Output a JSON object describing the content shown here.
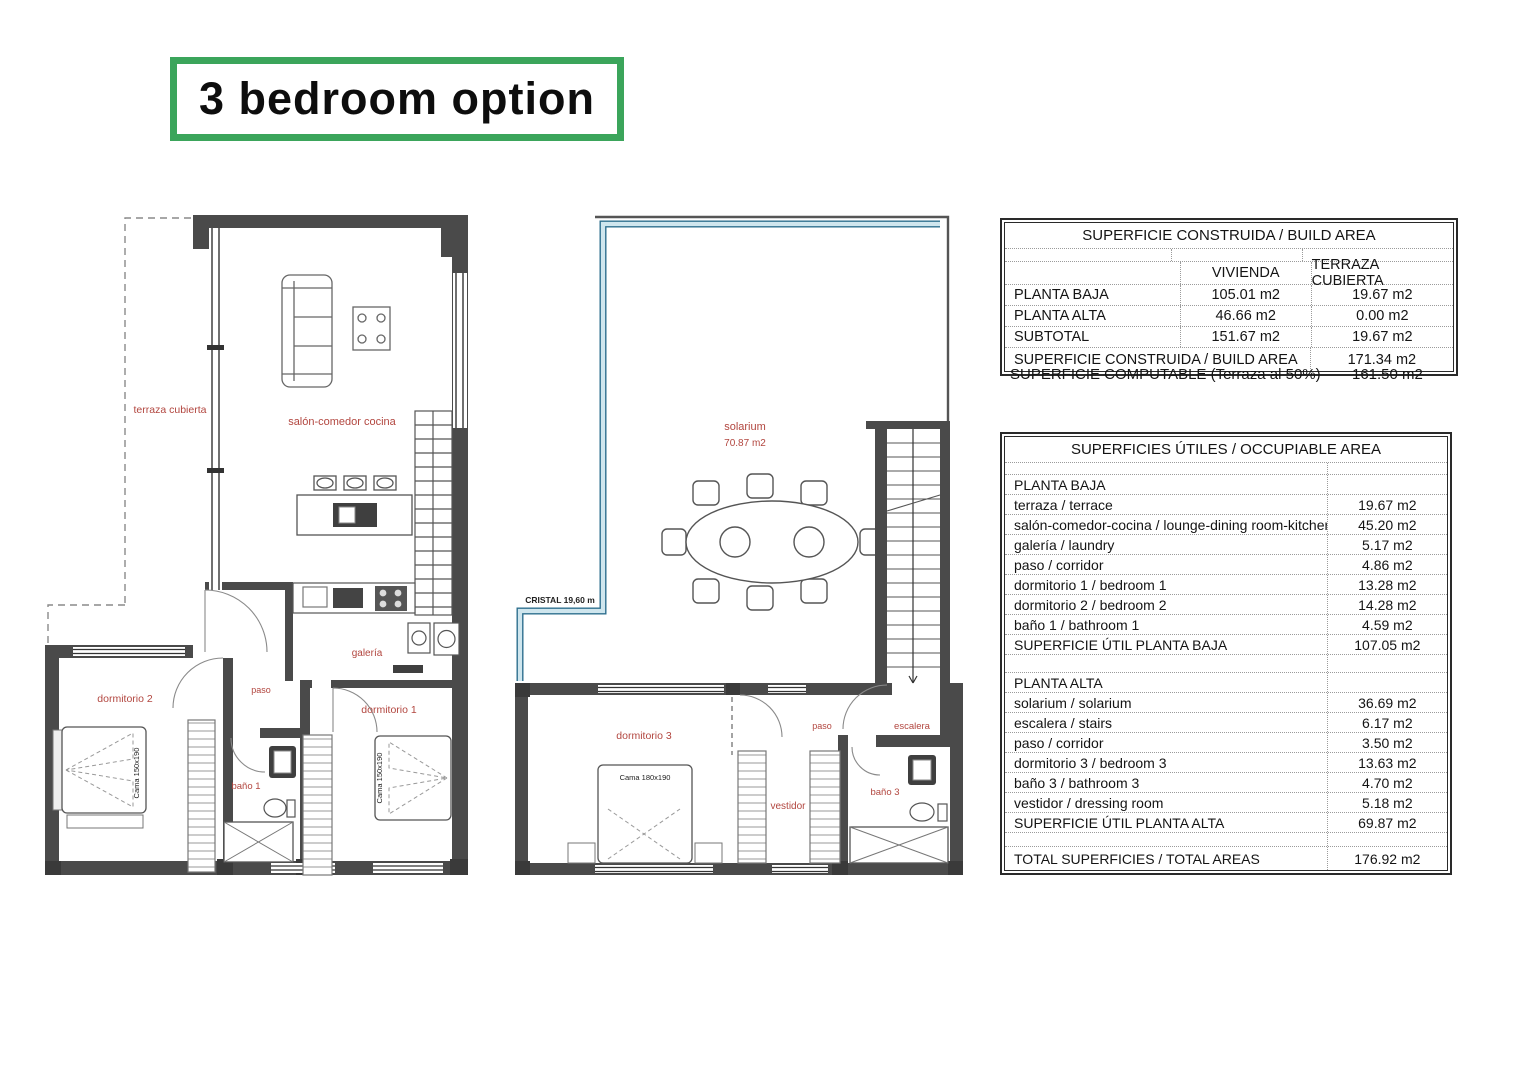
{
  "title": "3 bedroom option",
  "colors": {
    "title_border_green": "#3ba55b",
    "wall_gray": "#4a4a4a",
    "room_label_red": "#b2463f",
    "glass_blue_light": "#cfe6ee",
    "glass_blue_dark": "#2e6f8e",
    "table_border": "#2a2a2a",
    "dotted_line": "#9b9b9b"
  },
  "build_area_table": {
    "title": "SUPERFICIE CONSTRUIDA / BUILD AREA",
    "col_headers": {
      "vivienda": "VIVIENDA",
      "terraza": "TERRAZA CUBIERTA"
    },
    "rows": [
      {
        "label": "PLANTA BAJA",
        "vivienda": "105.01 m2",
        "terraza": "19.67 m2"
      },
      {
        "label": "PLANTA ALTA",
        "vivienda": "46.66 m2",
        "terraza": "0.00 m2"
      },
      {
        "label": "SUBTOTAL",
        "vivienda": "151.67 m2",
        "terraza": "19.67 m2"
      }
    ],
    "total_row": {
      "label": "SUPERFICIE CONSTRUIDA / BUILD AREA",
      "value": "171.34 m2"
    },
    "computable_row": {
      "label": "SUPERFICIE COMPUTABLE (Terraza al 50%)",
      "value": "161.50 m2"
    }
  },
  "occupiable_table": {
    "title": "SUPERFICIES ÚTILES / OCCUPIABLE AREA",
    "planta_baja": {
      "header": "PLANTA BAJA",
      "rows": [
        {
          "label": "terraza / terrace",
          "value": "19.67 m2"
        },
        {
          "label": "salón-comedor-cocina / lounge-dining room-kitchen",
          "value": "45.20 m2"
        },
        {
          "label": "galería / laundry",
          "value": "5.17 m2"
        },
        {
          "label": "paso / corridor",
          "value": "4.86 m2"
        },
        {
          "label": "dormitorio 1 / bedroom 1",
          "value": "13.28 m2"
        },
        {
          "label": "dormitorio 2 / bedroom 2",
          "value": "14.28 m2"
        },
        {
          "label": "baño 1 / bathroom 1",
          "value": "4.59 m2"
        }
      ],
      "subtotal": {
        "label": "SUPERFICIE ÚTIL PLANTA BAJA",
        "value": "107.05 m2"
      }
    },
    "planta_alta": {
      "header": "PLANTA ALTA",
      "rows": [
        {
          "label": "solarium / solarium",
          "value": "36.69 m2"
        },
        {
          "label": "escalera / stairs",
          "value": "6.17 m2"
        },
        {
          "label": "paso / corridor",
          "value": "3.50 m2"
        },
        {
          "label": "dormitorio 3 / bedroom 3",
          "value": "13.63 m2"
        },
        {
          "label": "baño 3 / bathroom 3",
          "value": "4.70 m2"
        },
        {
          "label": "vestidor / dressing room",
          "value": "5.18 m2"
        }
      ],
      "subtotal": {
        "label": "SUPERFICIE ÚTIL PLANTA ALTA",
        "value": "69.87 m2"
      }
    },
    "total_row": {
      "label": "TOTAL SUPERFICIES / TOTAL AREAS",
      "value": "176.92 m2"
    }
  },
  "ground_floor": {
    "labels": {
      "terraza": "terraza cubierta",
      "salon": "salón-comedor cocina",
      "galeria": "galería",
      "paso": "paso",
      "dormitorio_2": "dormitorio 2",
      "dormitorio_1": "dormitorio 1",
      "bano_1": "baño 1",
      "cama_dorm2": "Cama 150x190",
      "cama_dorm1": "Cama 150x190"
    }
  },
  "upper_floor": {
    "labels": {
      "solarium": "solarium",
      "solarium_area": "70.87 m2",
      "cristal": "CRISTAL 19,60 m",
      "dormitorio_3": "dormitorio 3",
      "cama_dorm3": "Cama 180x190",
      "vestidor": "vestidor",
      "paso": "paso",
      "escalera": "escalera",
      "bano_3": "baño 3"
    }
  }
}
